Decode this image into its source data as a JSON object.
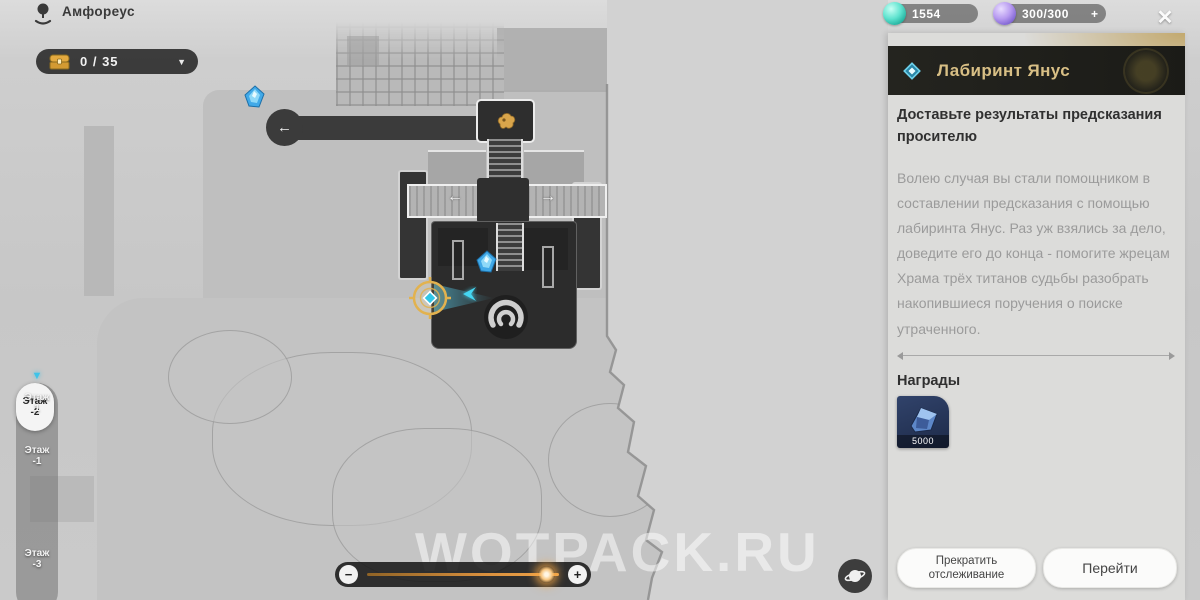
{
  "top_bar": {
    "location": "Амфореус",
    "chest_counter": "0 / 35",
    "currencies": [
      {
        "name": "gem-teal",
        "value": "1554"
      },
      {
        "name": "gem-purple",
        "value": "300/300",
        "add": "+"
      }
    ]
  },
  "icons": {
    "dropdown": "▼",
    "close": "✕",
    "arrow_left": "←",
    "arrow_right": "→",
    "minus": "−",
    "plus": "+",
    "floor_pointer": "▼"
  },
  "floor_selector": [
    {
      "name": "Этаж",
      "num": "1"
    },
    {
      "name": "Этаж",
      "num": "-1"
    },
    {
      "name": "Этаж",
      "num": "-2"
    },
    {
      "name": "Этаж",
      "num": "-3"
    }
  ],
  "quest_panel": {
    "title": "Лабиринт Янус",
    "objective": "Доставьте результаты предсказания просителю",
    "description": "Волею случая вы стали помощником в составлении предсказания с помощью лабиринта Янус. Раз уж взялись за дело, доведите его до конца - помогите жрецам Храма трёх титанов судьбы разобрать накопившиеся поручения о поиске утраченного.",
    "rewards_label": "Награды",
    "reward_amount": "5000",
    "stop_tracking_button": "Прекратить отслеживание",
    "go_button": "Перейти"
  },
  "map": {
    "zoom_percent": 83
  },
  "watermark": "WOTPACK.RU",
  "colors": {
    "accent_gold": "#d8bf85",
    "accent_cyan": "#3ec3e8",
    "slider_orange": "#e0973f"
  }
}
